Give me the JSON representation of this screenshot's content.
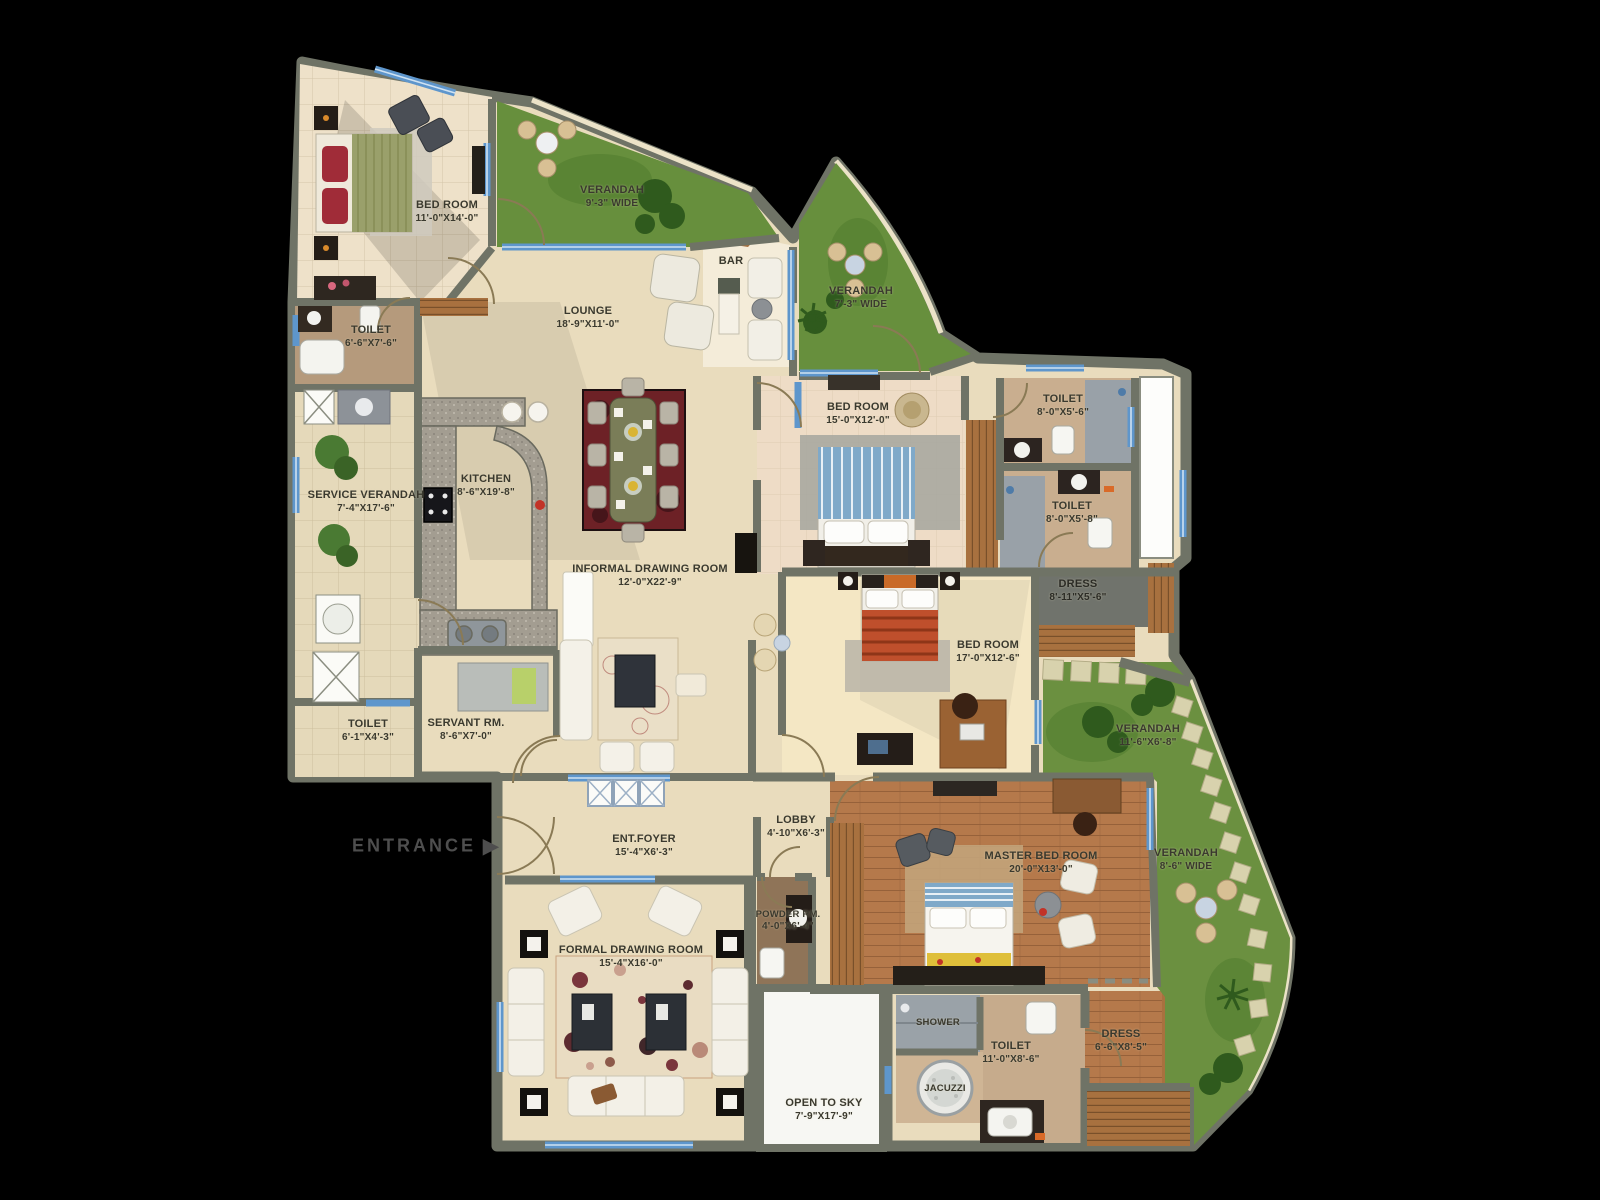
{
  "entrance": {
    "label": "ENTRANCE",
    "arrow": "▶"
  },
  "rooms": [
    {
      "name": "BED ROOM",
      "dims": "11'-0\"X14'-0\""
    },
    {
      "name": "VERANDAH",
      "dims": "9'-3\" WIDE"
    },
    {
      "name": "TOILET",
      "dims": "6'-6\"X7'-6\""
    },
    {
      "name": "LOUNGE",
      "dims": "18'-9\"X11'-0\""
    },
    {
      "name": "BAR",
      "dims": ""
    },
    {
      "name": "VERANDAH",
      "dims": "7'-3\" WIDE"
    },
    {
      "name": "BED ROOM",
      "dims": "15'-0\"X12'-0\""
    },
    {
      "name": "TOILET",
      "dims": "8'-0\"X5'-6\""
    },
    {
      "name": "TOILET",
      "dims": "8'-0\"X5'-8\""
    },
    {
      "name": "SERVICE VERANDAH",
      "dims": "7'-4\"X17'-6\""
    },
    {
      "name": "KITCHEN",
      "dims": "8'-6\"X19'-8\""
    },
    {
      "name": "INFORMAL DRAWING ROOM",
      "dims": "12'-0\"X22'-9\""
    },
    {
      "name": "DRESS",
      "dims": "8'-11\"X5'-6\""
    },
    {
      "name": "BED ROOM",
      "dims": "17'-0\"X12'-6\""
    },
    {
      "name": "TOILET",
      "dims": "6'-1\"X4'-3\""
    },
    {
      "name": "SERVANT RM.",
      "dims": "8'-6\"X7'-0\""
    },
    {
      "name": "VERANDAH",
      "dims": "11'-6\"X6'-8\""
    },
    {
      "name": "LOBBY",
      "dims": "4'-10\"X6'-3\""
    },
    {
      "name": "ENT.FOYER",
      "dims": "15'-4\"X6'-3\""
    },
    {
      "name": "MASTER BED ROOM",
      "dims": "20'-0\"X13'-0\""
    },
    {
      "name": "VERANDAH",
      "dims": "8'-6\" WIDE"
    },
    {
      "name": "POWDER RM.",
      "dims": "4'-0\"X6'-4\""
    },
    {
      "name": "FORMAL DRAWING ROOM",
      "dims": "15'-4\"X16'-0\""
    },
    {
      "name": "OPEN TO SKY",
      "dims": "7'-9\"X17'-9\""
    },
    {
      "name": "SHOWER",
      "dims": ""
    },
    {
      "name": "JACUZZI",
      "dims": ""
    },
    {
      "name": "TOILET",
      "dims": "11'-0\"X8'-6\""
    },
    {
      "name": "DRESS",
      "dims": "6'-6\"X8'-5\""
    }
  ],
  "colors": {
    "background": "#000000",
    "wall": "#6f7366",
    "floor": "#e9dcbd",
    "grass": "#6b9040",
    "wood": "#b5794b",
    "window": "#6aa0d4",
    "label_text": "#3a392e",
    "awning": "#f2e9cd"
  }
}
